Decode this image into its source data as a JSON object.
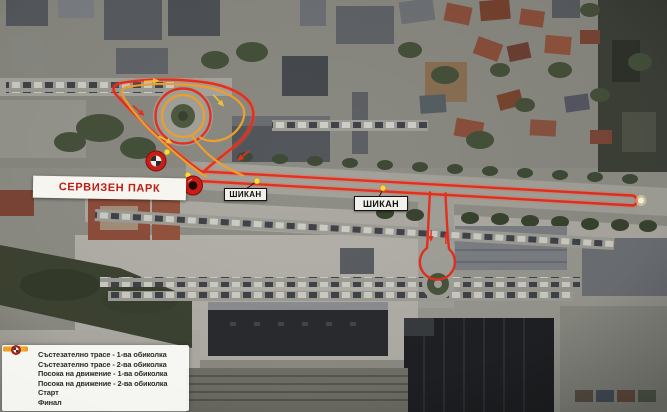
{
  "map": {
    "service_park_label": "СЕРВИЗЕН ПАРК",
    "chicane_labels": [
      "ШИКАН",
      "ШИКАН"
    ]
  },
  "legend": {
    "items": [
      {
        "icon": "track-line-lap1",
        "color": "#d3271d",
        "label": "Състезателно трасе - 1-ва обиколка"
      },
      {
        "icon": "track-line-lap2",
        "color": "#ef9c1f",
        "label": "Състезателно трасе - 2-ва обиколка"
      },
      {
        "icon": "direction-arrow-lap1",
        "color": "#d3271d",
        "label": "Посока на движение - 1-ва обиколка"
      },
      {
        "icon": "direction-arrow-lap2",
        "color": "#eeb02a",
        "label": "Посока на движение - 2-ва обиколка"
      },
      {
        "icon": "start-marker",
        "color": "#c9201a",
        "label": "Старт"
      },
      {
        "icon": "finish-marker",
        "color": "#c9201a",
        "label": "Финал"
      }
    ]
  },
  "colors": {
    "track_lap1": "#e8301f",
    "track_lap2": "#f2a12c",
    "waypoint_dot": "#ffd94b",
    "label_text": "#bf1c15"
  }
}
